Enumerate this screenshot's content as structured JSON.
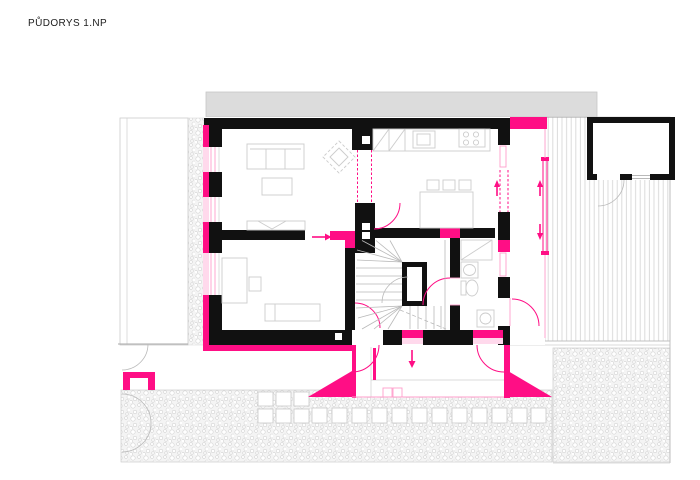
{
  "drawing": {
    "title": "PŮDORYS 1.NP"
  },
  "colors": {
    "accent": "#ff0e85",
    "accent_pale": "#ff9ecb",
    "accent_faint": "#ffd9ec",
    "wall_black": "#111111",
    "neighbor_gray": "#dcdcdc",
    "line_gray": "#b9b9b9",
    "furniture_gray": "#cccccc",
    "ground_bg": "#f4f4f4",
    "title_color": "#1c1c1c",
    "paper": "#ffffff"
  },
  "legend": {
    "existing_walls": "black",
    "new_construction": "magenta",
    "furniture_outlines": "light-gray"
  }
}
